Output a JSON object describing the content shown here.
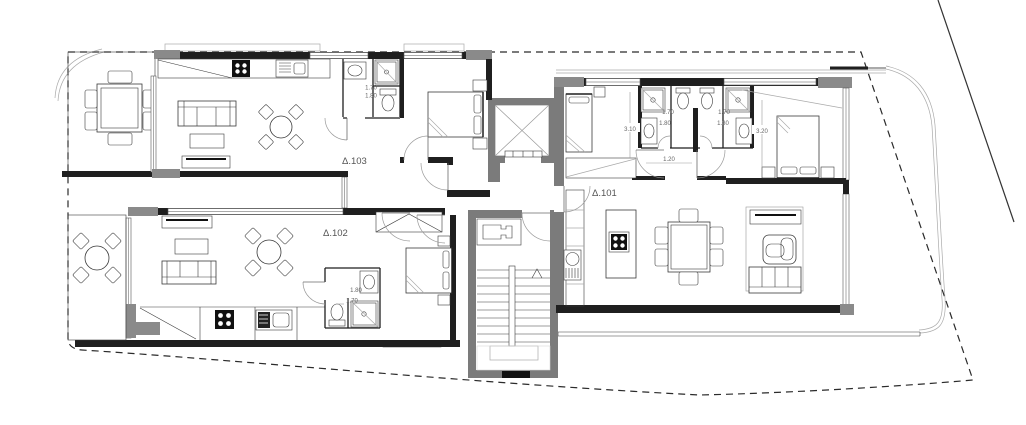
{
  "drawing": {
    "type": "architectural-floor-plan",
    "description": "Apartment building floor plan with three units around a central elevator and stair core, site boundary shown dashed"
  },
  "apartments": {
    "a101": {
      "label": "Δ.101"
    },
    "a102": {
      "label": "Δ.102"
    },
    "a103": {
      "label": "Δ.103"
    }
  },
  "dimensions": {
    "a103_bath_width": "1.70",
    "a103_bath_depth": "1.80",
    "a101_left_room": "3.10",
    "a101_bath_left_width": "1.70",
    "a101_bath_left_depth": "1.80",
    "a101_bath_right_width": "1.70",
    "a101_bath_right_depth": "1.80",
    "a101_corridor": "1.20",
    "a101_right_room": "3.20",
    "a102_bath_depth": "1.80",
    "a102_bath_width": "1.70"
  },
  "colors": {
    "wall": "#1f1f1f",
    "pier": "#8a8a8a",
    "core_wall": "#7b7b7b",
    "furniture_line": "#3a3a3a",
    "light_line": "#aaaaaa",
    "boundary": "#2b2b2b",
    "label_text": "#555555",
    "background": "#ffffff"
  }
}
